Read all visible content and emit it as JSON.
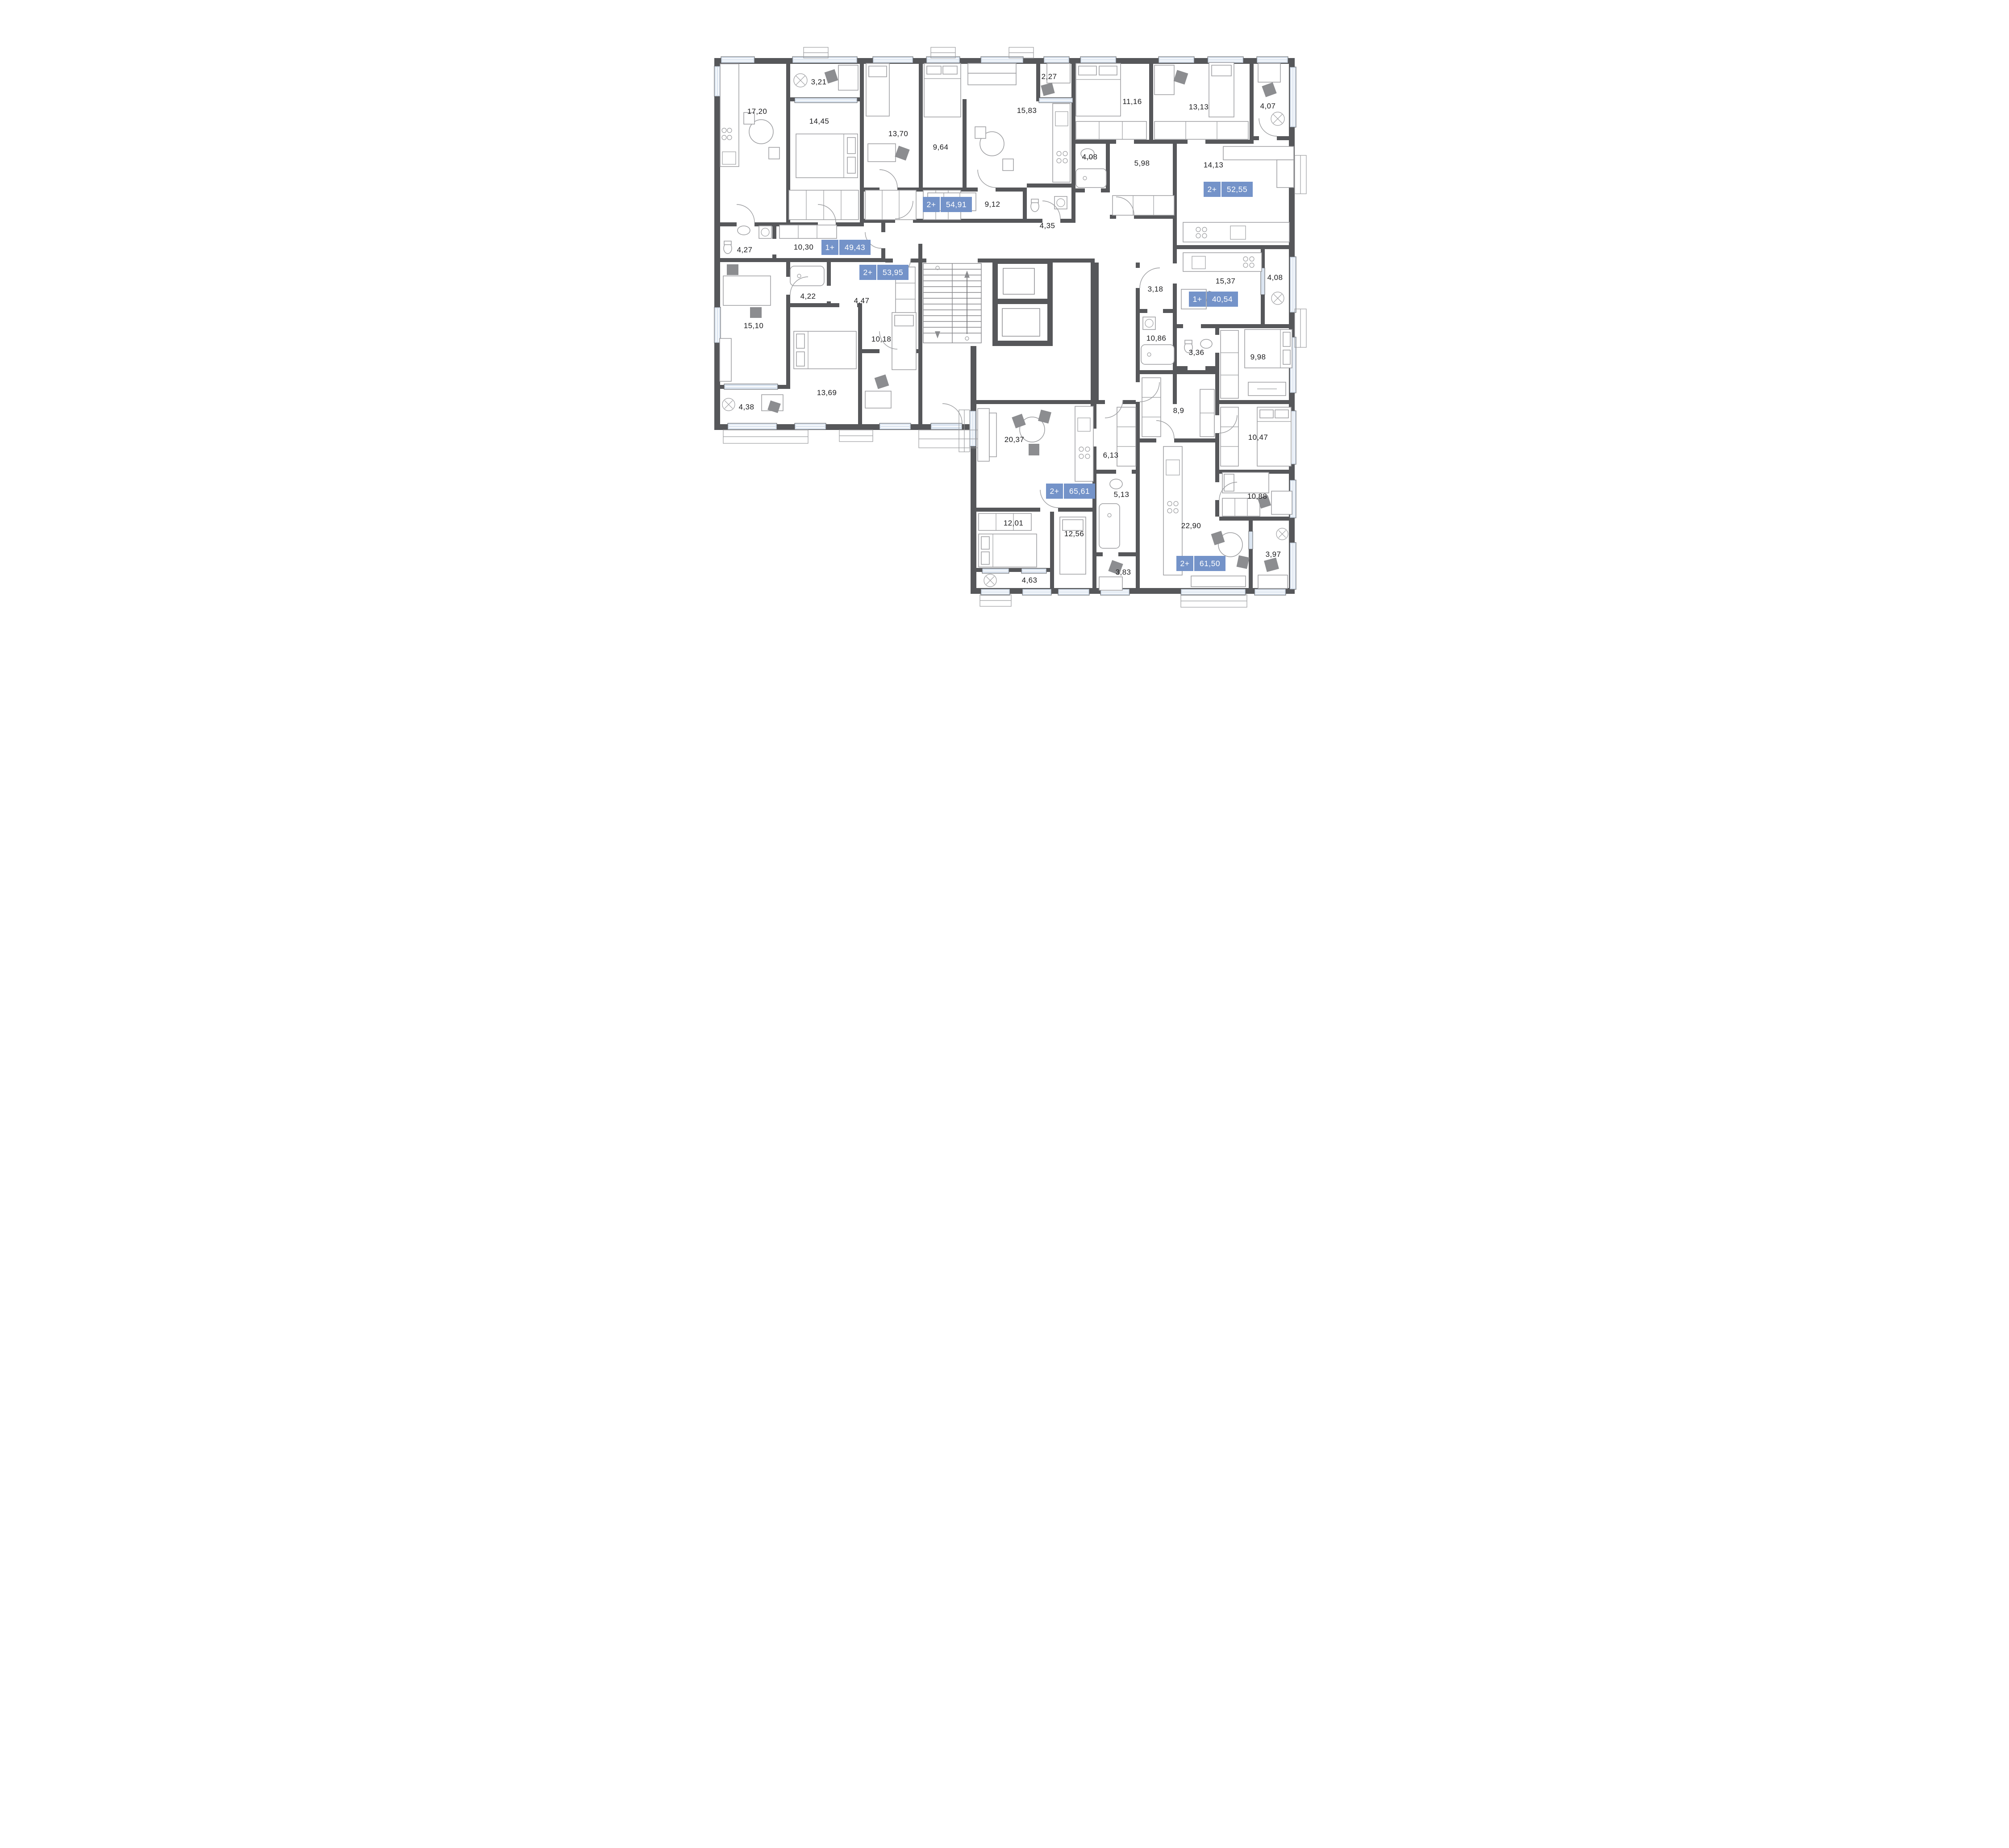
{
  "plan_type": "residential-floor-plan",
  "colors": {
    "wall": "#56575a",
    "window_glass": "#dbe5f1",
    "badge_blue": "#7493c9",
    "furniture_line": "#9b9c9f",
    "label_text": "#1c1c1e"
  },
  "apartments": [
    {
      "type": "1+",
      "area": "49,43"
    },
    {
      "type": "2+",
      "area": "54,91"
    },
    {
      "type": "2+",
      "area": "52,55"
    },
    {
      "type": "2+",
      "area": "53,95"
    },
    {
      "type": "1+",
      "area": "40,54"
    },
    {
      "type": "2+",
      "area": "65,61"
    },
    {
      "type": "2+",
      "area": "61,50"
    }
  ],
  "rooms": [
    "17,20",
    "3,21",
    "14,45",
    "13,70",
    "9,64",
    "15,83",
    "2,27",
    "9,12",
    "4,35",
    "11,16",
    "13,13",
    "4,07",
    "4,08",
    "5,98",
    "14,13",
    "4,27",
    "10,30",
    "15,37",
    "4,08",
    "3,18",
    "4,22",
    "4,47",
    "10,86",
    "15,10",
    "10,18",
    "3,36",
    "9,98",
    "4,38",
    "13,69",
    "8,9",
    "10,47",
    "20,37",
    "6,13",
    "10,88",
    "12,01",
    "5,13",
    "12,56",
    "22,90",
    "3,97",
    "3,83",
    "4,63"
  ]
}
